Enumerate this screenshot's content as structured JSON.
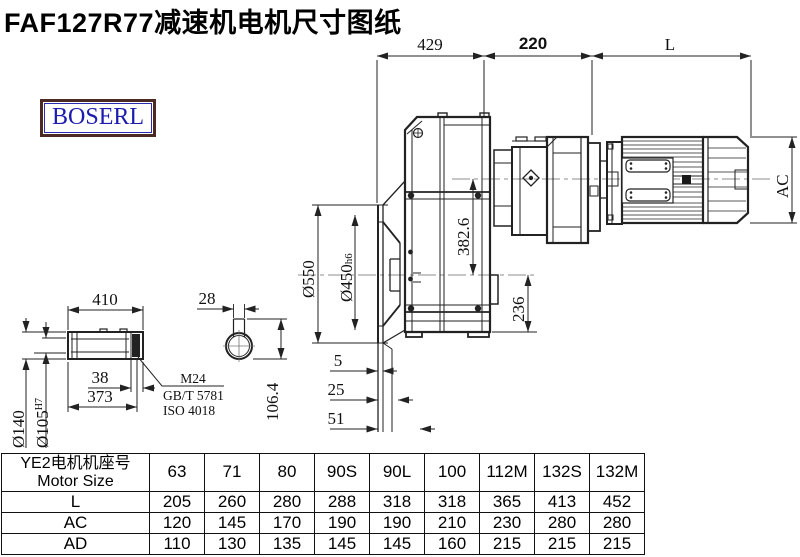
{
  "title": "FAF127R77减速机电机尺寸图纸",
  "logo": "BOSERL",
  "dims": {
    "w429": "429",
    "w220": "220",
    "wL": "L",
    "ac": "AC",
    "d550": "Ø550",
    "d450": "Ø450",
    "d450_suffix": "h6",
    "h382": "382.6",
    "h236": "236",
    "s410": "410",
    "s38": "38",
    "s373": "373",
    "d140": "Ø140",
    "d105": "Ø105",
    "d105_suffix": "H7",
    "k28": "28",
    "k106": "106.4",
    "e5": "5",
    "e25": "25",
    "e51": "51"
  },
  "notes": {
    "thread": "M24",
    "std1": "GB/T 5781",
    "std2": "ISO 4018"
  },
  "table": {
    "header_cn": "YE2电机机座号",
    "header_en": "Motor Size",
    "columns": [
      "63",
      "71",
      "80",
      "90S",
      "90L",
      "100",
      "112M",
      "132S",
      "132M"
    ],
    "rows": [
      {
        "label": "L",
        "values": [
          "205",
          "260",
          "280",
          "288",
          "318",
          "318",
          "365",
          "413",
          "452"
        ]
      },
      {
        "label": "AC",
        "values": [
          "120",
          "145",
          "170",
          "190",
          "190",
          "210",
          "230",
          "280",
          "280"
        ]
      },
      {
        "label": "AD",
        "values": [
          "110",
          "130",
          "135",
          "145",
          "145",
          "160",
          "215",
          "215",
          "215"
        ]
      }
    ]
  },
  "colors": {
    "logo_text": "#1c1caf",
    "logo_border": "#4b2a26",
    "line": "#222222"
  }
}
